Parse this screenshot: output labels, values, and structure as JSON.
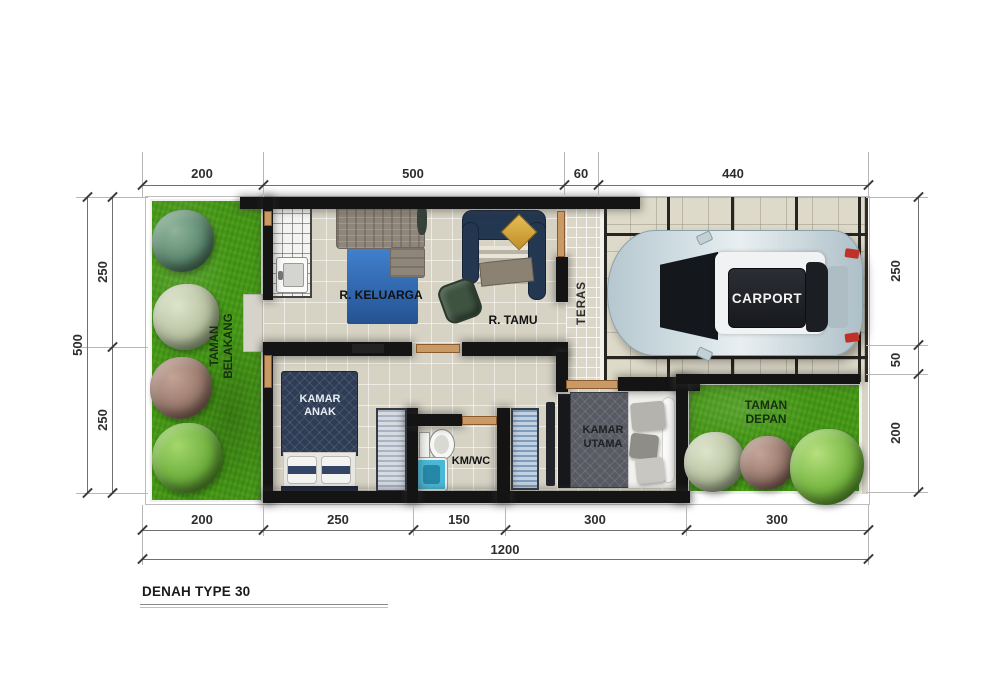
{
  "title": "DENAH TYPE 30",
  "dims": {
    "top": [
      "200",
      "500",
      "60",
      "440"
    ],
    "left_total": "500",
    "left": [
      "250",
      "250"
    ],
    "right": [
      "250",
      "50",
      "200"
    ],
    "bottom": [
      "200",
      "250",
      "150",
      "300",
      "300"
    ],
    "bottom_total": "1200"
  },
  "rooms": {
    "taman_belakang_1": "TAMAN",
    "taman_belakang_2": "BELAKANG",
    "r_keluarga": "R. KELUARGA",
    "r_tamu": "R. TAMU",
    "teras": "TERAS",
    "carport": "CARPORT",
    "kamar_anak_1": "KAMAR",
    "kamar_anak_2": "ANAK",
    "km_wc": "KM/WC",
    "kamar_utama_1": "KAMAR",
    "kamar_utama_2": "UTAMA",
    "taman_depan_1": "TAMAN",
    "taman_depan_2": "DEPAN"
  },
  "colors": {
    "wall": "#141414",
    "grass": "#459718",
    "floor_tile": "#d6d2c4",
    "rug_blue": "#3c76c0",
    "sofa_navy": "#243750",
    "pillow_yellow": "#d9a93c",
    "car_body": "#c9d7dc",
    "door_frame": "#c99a66",
    "shower_blue": "#49b8d6"
  }
}
